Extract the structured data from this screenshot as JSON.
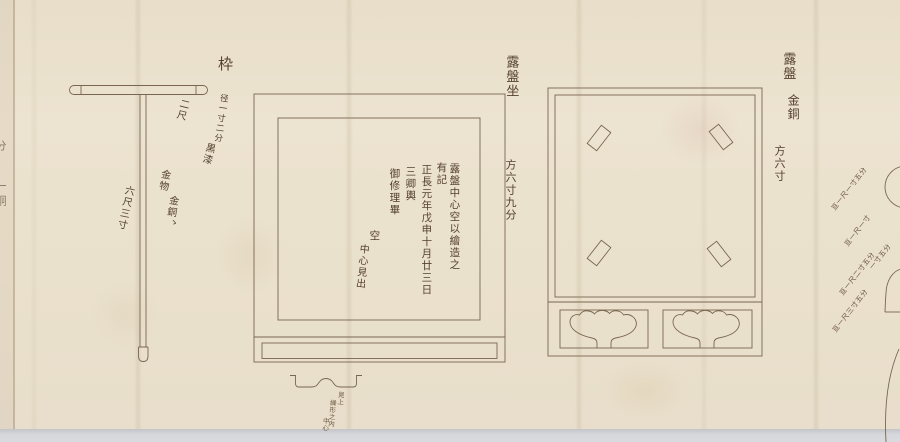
{
  "scroll": {
    "paper_color": "#ebe2ce",
    "line_color": "#7a6650",
    "ink_color": "#54402e",
    "desk_color": "#d4d5d9"
  },
  "staff": {
    "title": "枠",
    "diameter_note": "径一寸二分",
    "bar_length": "二尺",
    "lacquer_note": "黒漆",
    "metal_note_1": "金物",
    "metal_note_2": "金銅",
    "metal_mark": "ゝ",
    "pole_length": "六尺三寸"
  },
  "robanza": {
    "title": "露盤坐",
    "dimension": "方六寸九分",
    "inscription": [
      "露盤中心空以繪造之",
      "有記",
      "正長元年戊申十月廿三日",
      "三卿輿",
      "御修理畢"
    ],
    "center_note_1": "空",
    "center_note_2": "中心見出",
    "profile_notes": [
      "見上",
      "繰形之内",
      "中心"
    ]
  },
  "roban": {
    "title": "露盤",
    "material": "金銅",
    "dimension": "方六寸"
  },
  "edge_notes": {
    "right": [
      "亘一尺一寸五分",
      "亘一尺一寸",
      "一寸五分",
      "亘一尺二寸五分",
      "亘一尺三寸五分"
    ],
    "left_fragments": [
      "分",
      "一",
      "銅"
    ]
  }
}
